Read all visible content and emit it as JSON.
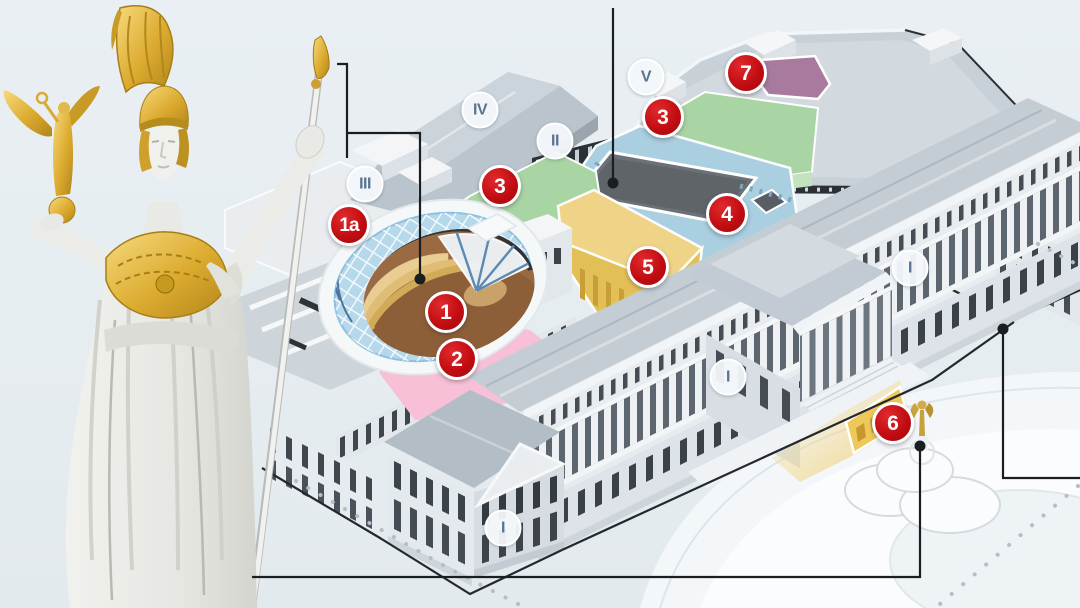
{
  "figure": {
    "kind": "building-cutaway-infographic",
    "background_color": "#e8eef2"
  },
  "map": {
    "marker_color": "#c20d12",
    "roman_text_color": "#5a7390",
    "red_markers": [
      {
        "label": "1a",
        "x": 349,
        "y": 225
      },
      {
        "label": "1",
        "x": 446,
        "y": 312
      },
      {
        "label": "2",
        "x": 457,
        "y": 359
      },
      {
        "label": "3",
        "x": 500,
        "y": 186
      },
      {
        "label": "3",
        "x": 663,
        "y": 117
      },
      {
        "label": "4",
        "x": 727,
        "y": 214
      },
      {
        "label": "5",
        "x": 648,
        "y": 267
      },
      {
        "label": "6",
        "x": 893,
        "y": 423
      },
      {
        "label": "7",
        "x": 746,
        "y": 73
      }
    ],
    "roman_markers": [
      {
        "label": "I",
        "x": 910,
        "y": 268
      },
      {
        "label": "I",
        "x": 728,
        "y": 377
      },
      {
        "label": "I",
        "x": 503,
        "y": 528
      },
      {
        "label": "II",
        "x": 555,
        "y": 141
      },
      {
        "label": "III",
        "x": 365,
        "y": 184
      },
      {
        "label": "IV",
        "x": 480,
        "y": 110
      },
      {
        "label": "V",
        "x": 646,
        "y": 77
      }
    ],
    "zones": [
      {
        "label": "1",
        "color": "#9a6a42"
      },
      {
        "label": "1a",
        "color": "#b5d8ea"
      },
      {
        "label": "2",
        "color": "#f7c0d6"
      },
      {
        "label": "3",
        "color": "#a9d4a4"
      },
      {
        "label": "3",
        "color": "#a9d4a4"
      },
      {
        "label": "4",
        "color": "#aacfe0"
      },
      {
        "label": "5",
        "color": "#efd487"
      },
      {
        "label": "6",
        "color": "#eec859"
      },
      {
        "label": "7",
        "color": "#a87b9e"
      }
    ],
    "leader_lines": {
      "color": "#1b1e20",
      "lines": [
        {
          "points": "337,64 347,64 347,158"
        },
        {
          "points": "347,133 420,133 420,279",
          "dot": {
            "x": 420,
            "y": 279
          }
        },
        {
          "points": "613,8 613,183",
          "dot": {
            "x": 613,
            "y": 183
          }
        },
        {
          "points": "920,446 920,577 252,577",
          "dot": {
            "x": 920,
            "y": 446
          }
        },
        {
          "points": "1003,329 1003,478 1080,478",
          "dot": {
            "x": 1003,
            "y": 329
          }
        }
      ]
    }
  }
}
